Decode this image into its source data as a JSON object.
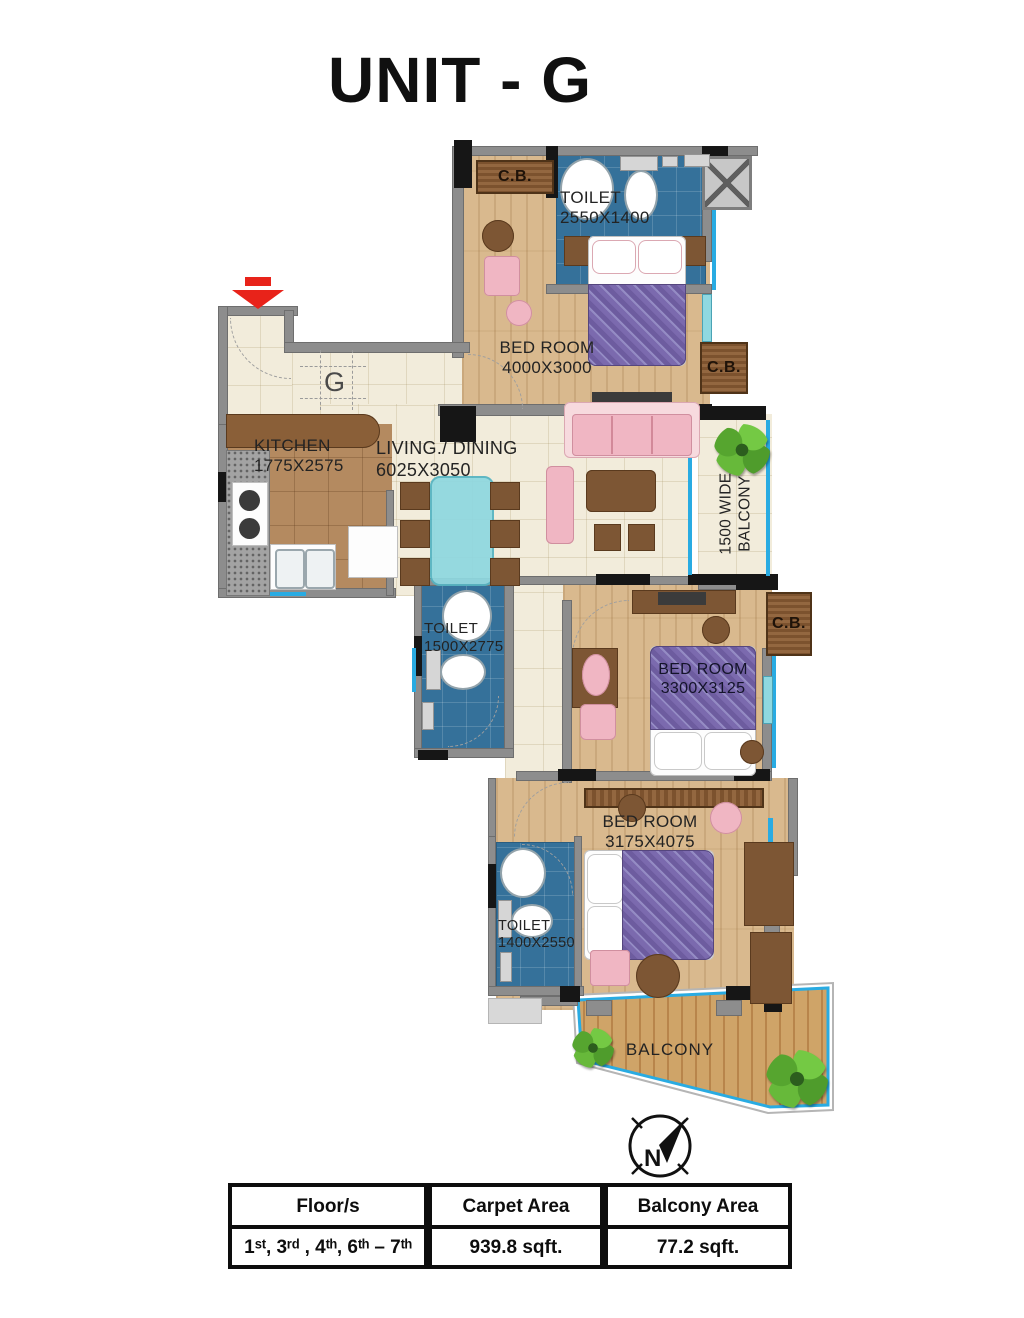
{
  "title": "UNIT - G",
  "plan": {
    "unit_letter": "G",
    "compass_letter": "N",
    "cupboard_label": "C.B.",
    "rooms": {
      "toilet_top": {
        "name": "TOILET",
        "dims": "2550X1400"
      },
      "bedroom_top": {
        "name": "BED ROOM",
        "dims": "4000X3000"
      },
      "kitchen": {
        "name": "KITCHEN",
        "dims": "1775X2575"
      },
      "living_dining": {
        "name": "LIVING./ DINING",
        "dims": "6025X3050"
      },
      "balcony_side": {
        "line1": "1500 WIDE",
        "line2": "BALCONY"
      },
      "toilet_mid": {
        "name": "TOILET",
        "dims": "1500X2775"
      },
      "bedroom_mid": {
        "name": "BED ROOM",
        "dims": "3300X3125"
      },
      "bedroom_bottom": {
        "name": "BED ROOM",
        "dims": "3175X4075"
      },
      "toilet_bottom": {
        "name": "TOILET",
        "dims": "1400X2550"
      },
      "balcony_bottom": {
        "name": "BALCONY"
      }
    }
  },
  "area_table": {
    "headers": [
      "Floor/s",
      "Carpet Area",
      "Balcony Area"
    ],
    "values": [
      "1ˢᵗ, 3ʳᵈ , 4ᵗʰ, 6ᵗʰ – 7ᵗʰ",
      "939.8 sqft.",
      "77.2 sqft."
    ]
  },
  "colors": {
    "wall_gray": "#8d8d8d",
    "wall_black": "#161616",
    "toilet_blue": "#35719a",
    "wood_floor": "#d9b98e",
    "beige_tile": "#f2ecdb",
    "kitchen_tile": "#b48a60",
    "bed_purple": "#7c6cab",
    "accent_pink": "#f0b6c3",
    "table_teal": "#8fd8e0",
    "balcony_cyan": "#29abe2",
    "furniture_brown": "#7d5634",
    "entry_red": "#e8231a",
    "plant_green": "#5aa832"
  }
}
